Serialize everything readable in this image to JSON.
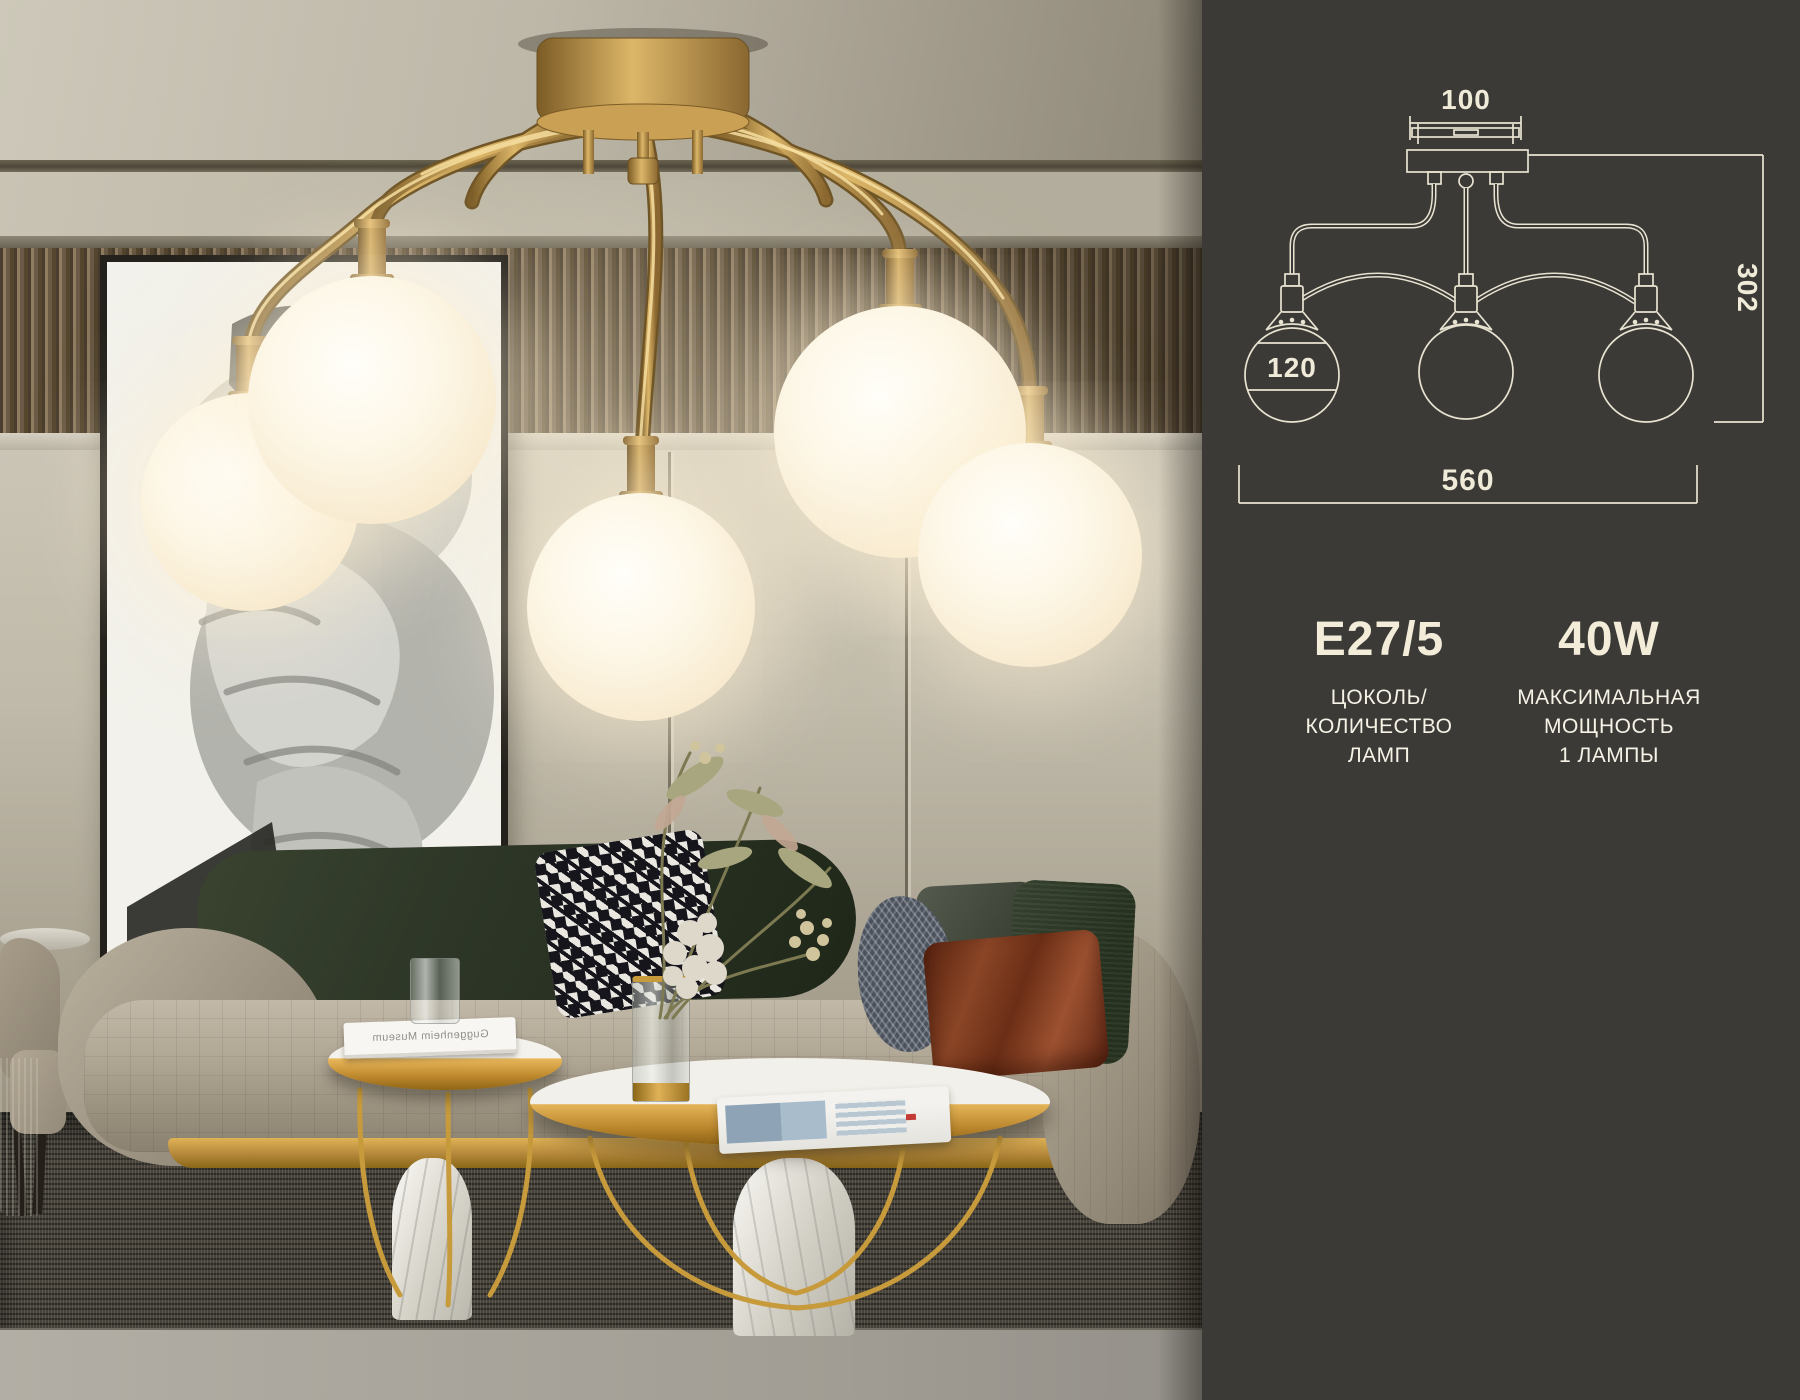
{
  "photo": {
    "book_title_mirrored": "Guggenheim Museum",
    "colors": {
      "brass": "#b8914c",
      "globe_glow": "#fdf3da",
      "wall": "#c0baaa",
      "sofa_green": "#2c3526",
      "rug": "#3d3a33"
    }
  },
  "panel": {
    "background_color": "#3b3a37",
    "line_color": "#e9e3d1",
    "text_color": "#f2ecd9",
    "diagram": {
      "dim_canopy_width": "100",
      "dim_height": "302",
      "dim_globe_diameter": "120",
      "dim_total_width": "560"
    },
    "specs": [
      {
        "value": "E27/5",
        "lines": [
          "ЦОКОЛЬ/",
          "КОЛИЧЕСТВО",
          "ЛАМП"
        ]
      },
      {
        "value": "40W",
        "lines": [
          "МАКСИМАЛЬНАЯ",
          "МОЩНОСТЬ",
          "1 ЛАМПЫ"
        ]
      }
    ]
  }
}
